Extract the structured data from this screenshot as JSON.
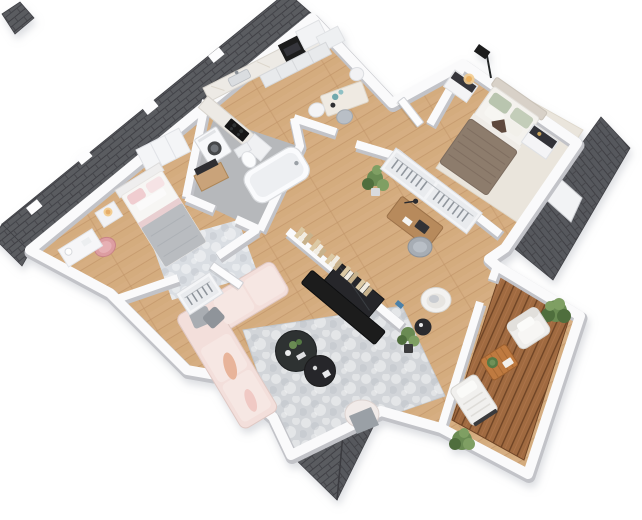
{
  "scene": {
    "description": "Photorealistic 3D rendered top-down floor plan of an apartment, rotated diagonally on a white background",
    "view": "3d-floor-plan-isometric",
    "background_color": "#ffffff"
  },
  "palette": {
    "wall": "#fafafb",
    "wall_edge": "#c2c3c8",
    "wood_floor": "#d6ae82",
    "wood_line": "#bb8f60",
    "roof_shingle": "#5a5b60",
    "roof_line": "#3f4045",
    "deck_wood": "#a06a41",
    "deck_line": "#6f4526",
    "bath_floor": "#b6b8bb",
    "rug_living": "#d2d5d9",
    "rug_master": "#eae5dc",
    "rug_bedroom": "#dadee3",
    "sofa_pink": "#f3dfdb",
    "sofa_outline": "#e0c9c4",
    "duvet_master": "#8d7b6c",
    "blanket_gray": "#b9bcc0",
    "pink_chair": "#dd9da1",
    "counter_marble": "#edeae5",
    "appliance_dark": "#1a1b1d",
    "desk_wood": "#b78a5c",
    "balcony_table": "#bf7a3f",
    "plant_dark": "#4f6e3d",
    "plant_mid": "#6a8b52",
    "plant_light": "#7f9f64",
    "lamp_glow": "#f3cd92",
    "teal_accent": "#6fa8ad",
    "headboard": "#d8d1c8",
    "pillow_sage": "#b9c5af",
    "coffee_table_dark": "#2f3033",
    "tv_black": "#1c1d1f"
  },
  "rooms": [
    {
      "id": "kitchen",
      "name": "kitchen"
    },
    {
      "id": "dining-nook",
      "name": "dining nook"
    },
    {
      "id": "bathroom-laundry",
      "name": "bathroom with laundry"
    },
    {
      "id": "bedroom-2",
      "name": "second bedroom"
    },
    {
      "id": "hallway",
      "name": "entry hallway"
    },
    {
      "id": "home-office",
      "name": "home office / wardrobe corridor"
    },
    {
      "id": "master-bedroom",
      "name": "master bedroom"
    },
    {
      "id": "living-room",
      "name": "living room"
    },
    {
      "id": "balcony",
      "name": "balcony terrace"
    }
  ],
  "furniture": {
    "kitchen": [
      "marble-counter",
      "sink",
      "oven-column",
      "fridge-cabinets",
      "cooktop",
      "lower-cabinets"
    ],
    "dining_nook": [
      "dining-table",
      "white-chair",
      "gray-chair",
      "teal-vases"
    ],
    "bathroom": [
      "washing-machine",
      "toilet",
      "bathtub"
    ],
    "bedroom_2": [
      "double-bed-pink",
      "nightstand-lamp",
      "wardrobe",
      "media-side-table",
      "pink-round-chair",
      "vanity-desk",
      "patch-rug"
    ],
    "home_office": [
      "wood-desk",
      "desk-lamp",
      "laptop",
      "gray-chair",
      "open-wardrobe-hangers",
      "potted-plant"
    ],
    "master_bedroom": [
      "double-bed-taupe",
      "headboard",
      "nightstand-left",
      "nightstand-right",
      "table-lamp",
      "floor-lamp",
      "cream-rug"
    ],
    "living_room": [
      "pink-sectional-sofa",
      "gray-pillows",
      "round-coffee-table-large",
      "round-coffee-table-small",
      "ottoman-gray-throw",
      "tv-console",
      "flatscreen-tv",
      "book-row",
      "white-shell-armchair",
      "dark-side-table",
      "potted-plant",
      "shoe-closet-hangers",
      "gray-rug"
    ],
    "balcony": [
      "deck-armchair",
      "wood-coffee-table",
      "sun-lounger",
      "boxwood-bush-north",
      "boxwood-bush-south"
    ]
  },
  "exterior": {
    "roof_pieces": [
      "north-roof-strip",
      "northwest-corner-roof",
      "east-roof-slope",
      "east-roof-dormer",
      "south-gable-roof"
    ],
    "doors": [
      "bedroom2-door-leaf",
      "master-hall-door-leaf"
    ]
  }
}
